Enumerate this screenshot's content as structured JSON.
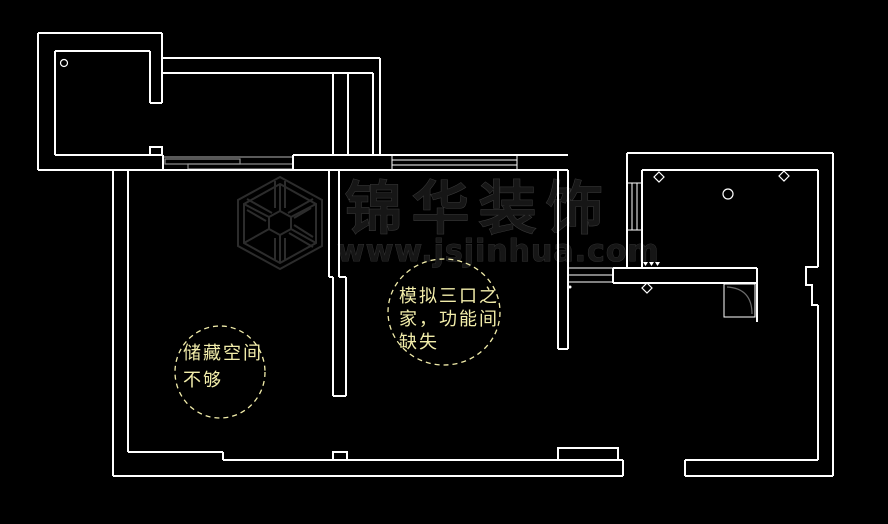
{
  "canvas": {
    "width": 888,
    "height": 524,
    "background_color": "#000000",
    "wall_color": "#ffffff",
    "fixture_gray_color": "#909090"
  },
  "watermark": {
    "brand": "锦华装饰",
    "url": "www.jsjinhua.com",
    "text_fill": "#161616",
    "text_edge": "#3c3c3c",
    "logo": "jinhua-cube-logo"
  },
  "annotations": [
    {
      "id": "storage",
      "lines": [
        "储藏空间",
        "不够"
      ],
      "color": "#f2edaa"
    },
    {
      "id": "family",
      "lines": [
        "模拟三口之",
        "家，功能间",
        "缺失"
      ],
      "color": "#f2edaa"
    }
  ]
}
